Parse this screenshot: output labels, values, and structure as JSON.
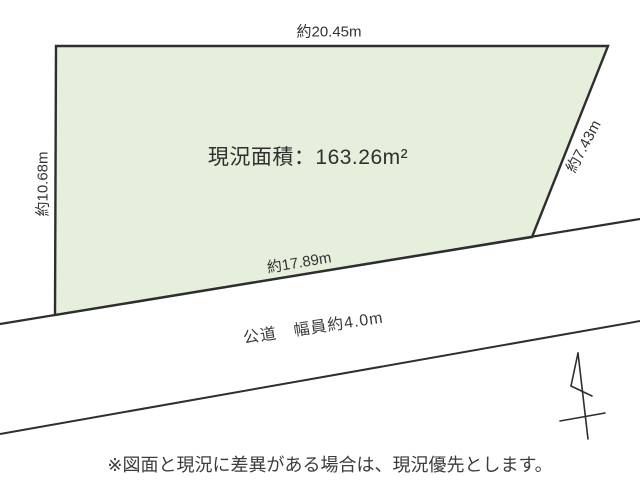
{
  "colors": {
    "plot_fill": "#e5efdb",
    "line": "#2e2e2e",
    "text": "#333333"
  },
  "plot": {
    "area_caption": "現況面積：",
    "area_value": "163.26m²",
    "dim_top": "約20.45m",
    "dim_left": "約10.68m",
    "dim_right": "約7.43m",
    "dim_bottom": "約17.89m"
  },
  "road": {
    "label": "公道　幅員約4.0m"
  },
  "north_arrow": "north-arrow",
  "note": "※図面と現況に差異がある場合は、現況優先とします。"
}
